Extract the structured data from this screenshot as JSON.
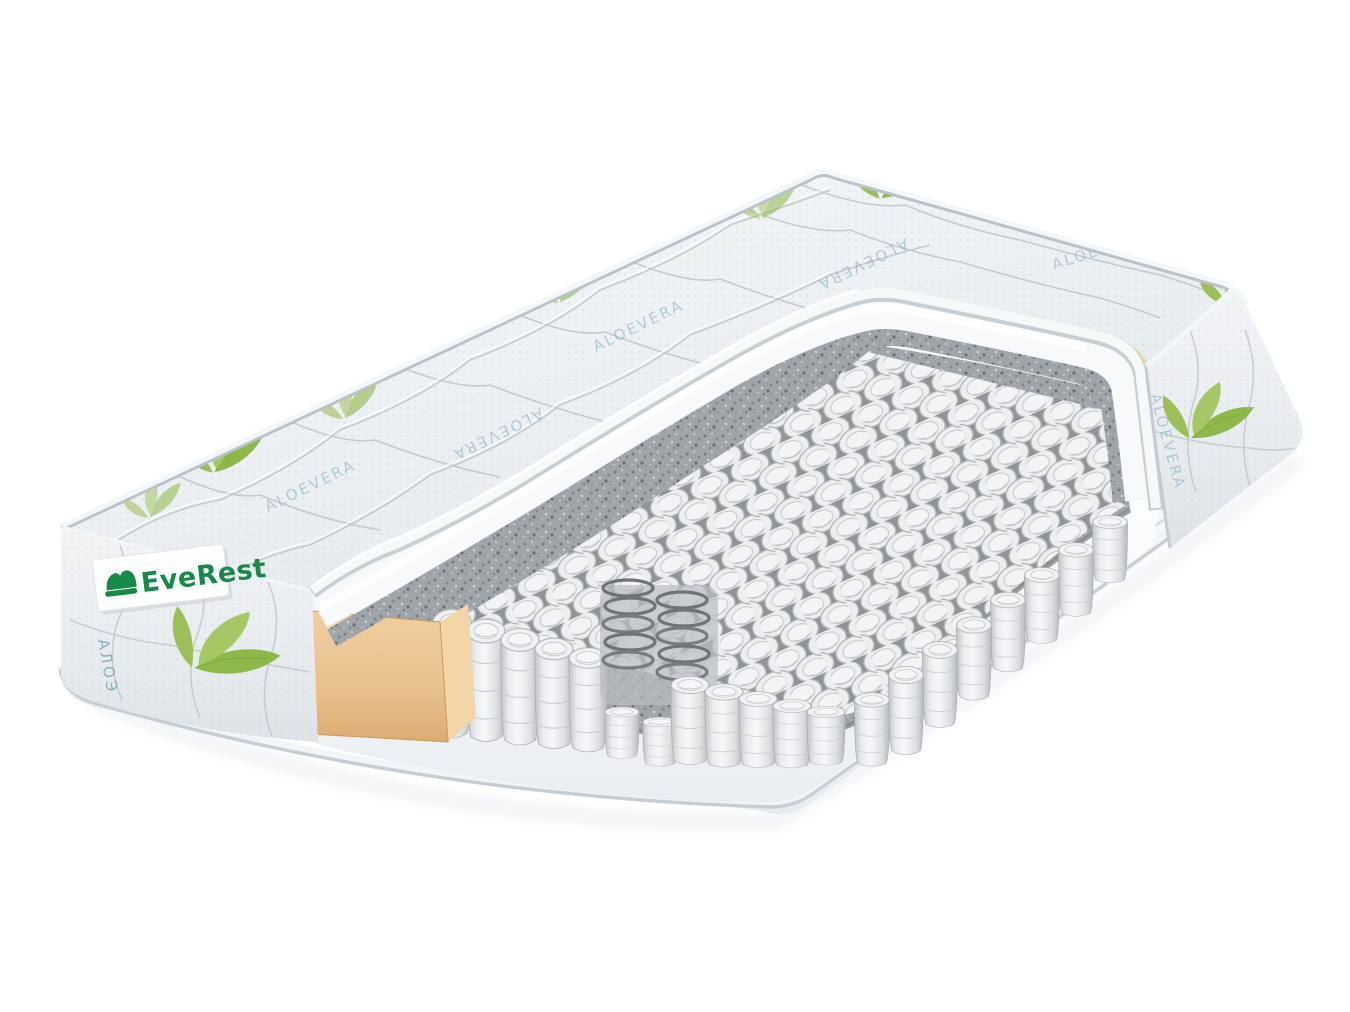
{
  "image": {
    "kind": "product-render",
    "subject": "Cutaway 3D render of a pocket-spring mattress showing internal layers",
    "background": "#ffffff"
  },
  "brand": {
    "name": "EveRest",
    "wordmark_color": "#17894a",
    "label_background": "#ffffff",
    "icon": "bed-logo-icon"
  },
  "fabric": {
    "repeat_text": "ALOEVERA",
    "side_vertical_text": "АЛОЭ",
    "text_color": "#74a7b9",
    "leaf_green": "#8fb84a",
    "leaf_green_light": "#b5d07d",
    "cover_base": "#eff2f4",
    "quilt_seam": "#b8c1c9"
  },
  "materials": {
    "foam_white": "#f7f9fa",
    "felt_gray": "#a0a5a9",
    "felt_speckle_dark": "#73787c",
    "spring_fabric": "#edeff1",
    "spring_wire": "#6e7377",
    "foam_block_tan": "#e9c08f",
    "piping_cord": "#f3f6f8"
  }
}
